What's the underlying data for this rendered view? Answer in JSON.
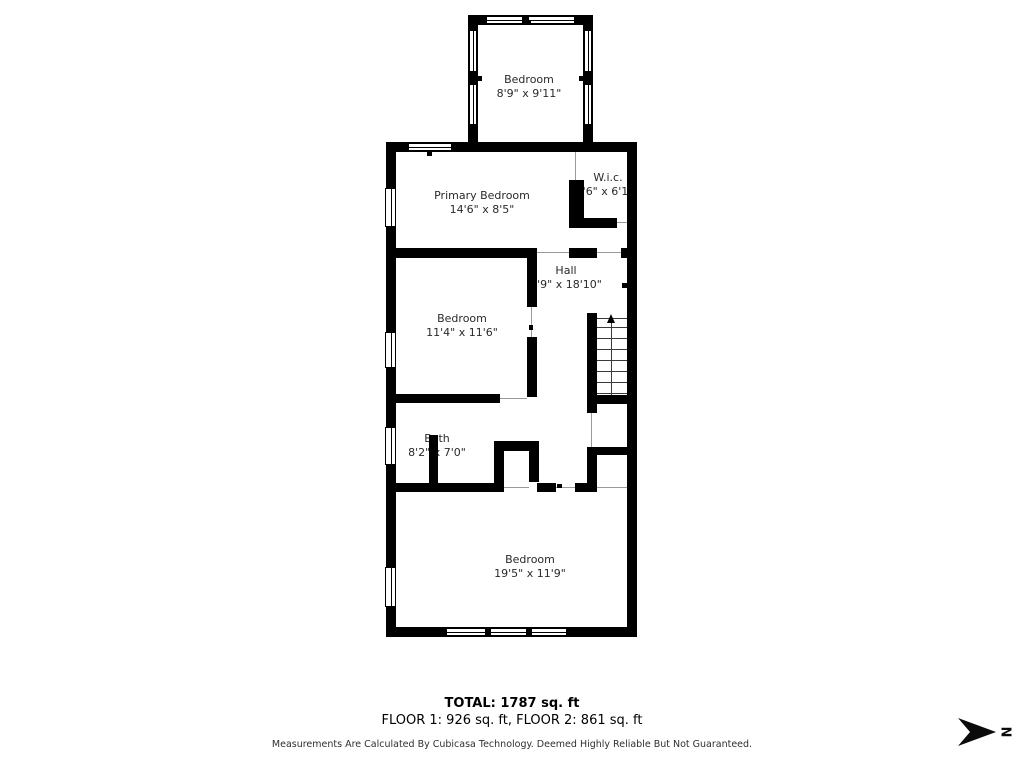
{
  "floorplan": {
    "rooms": [
      {
        "name": "Bedroom",
        "dims": "8'9\" x 9'11\""
      },
      {
        "name": "Primary Bedroom",
        "dims": "14'6\" x 8'5\""
      },
      {
        "name": "W.i.c.",
        "dims": "'6\" x 6'1\""
      },
      {
        "name": "Hall",
        "dims": "7'9\" x 18'10\""
      },
      {
        "name": "Bedroom",
        "dims": "11'4\" x 11'6\""
      },
      {
        "name": "Bath",
        "dims": "8'2\" x 7'0\""
      },
      {
        "name": "Bedroom",
        "dims": "19'5\" x 11'9\""
      }
    ],
    "colors": {
      "wall": "#000000",
      "background": "#ffffff",
      "text": "#2a2a2a"
    }
  },
  "footer": {
    "total": "TOTAL: 1787 sq. ft",
    "floors": "FLOOR 1: 926 sq. ft, FLOOR 2: 861 sq. ft",
    "disclaimer": "Measurements Are Calculated By Cubicasa Technology. Deemed Highly Reliable But Not Guaranteed."
  },
  "compass": {
    "label": "N"
  }
}
